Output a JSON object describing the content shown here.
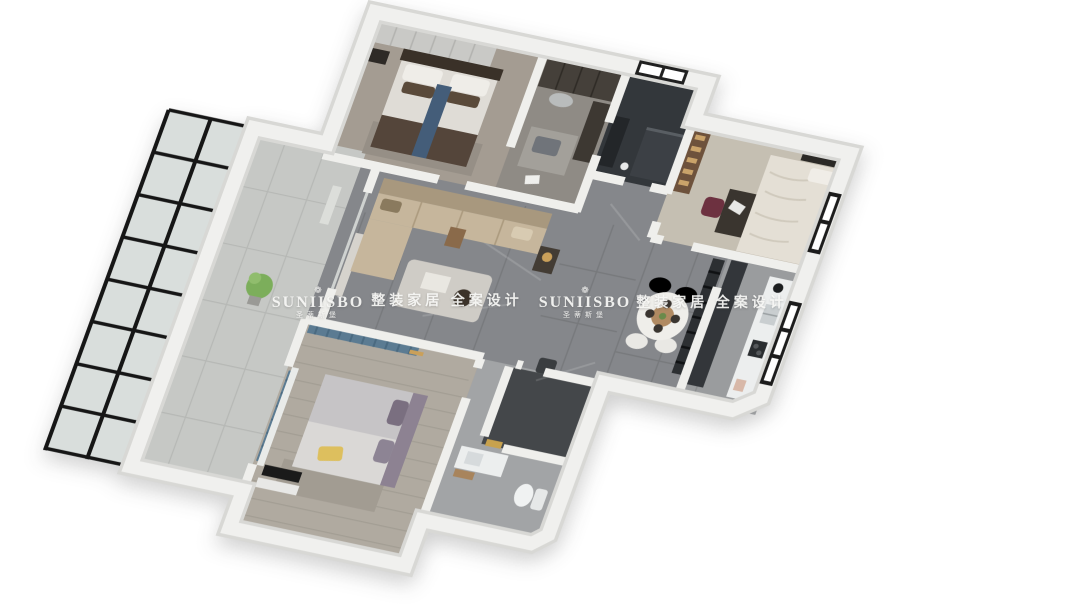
{
  "image_type": "3d-apartment-floorplan-render",
  "watermarks": {
    "logo_icon": "❁",
    "instances": [
      {
        "brand": "SUNIISBO",
        "brand_cn": "圣蒂斯堡",
        "tagline": "整装家居 全案设计"
      },
      {
        "brand": "SUNIISBO",
        "brand_cn": "圣蒂斯堡",
        "tagline": "整装家居 全案设计"
      }
    ]
  },
  "colors": {
    "background": "#ffffff",
    "wall_top": "#f0f0ee",
    "wall_edge": "#d8d8d5",
    "floor_marble": "#85878b",
    "floor_wood_master": "#a49c92",
    "floor_wood_bedroom2": "#b0aaa0",
    "floor_study": "#c5bfb2",
    "ensuite_dark_tile": "#33373b",
    "shower_dark_tile": "#44474a",
    "balcony_glass": "#d9dedc",
    "glass_frame_black": "#161616",
    "sofa_beige": "#c6b69c",
    "bed_runner_blue": "#445d79",
    "curtain_blue": "#5b7b92",
    "pillow_yellow": "#ddbf5e",
    "chair_maroon": "#6d3140",
    "plant_green": "#7cae5b",
    "gold_handle": "#c8a24e",
    "watermark_text": "#f8f8f6"
  }
}
